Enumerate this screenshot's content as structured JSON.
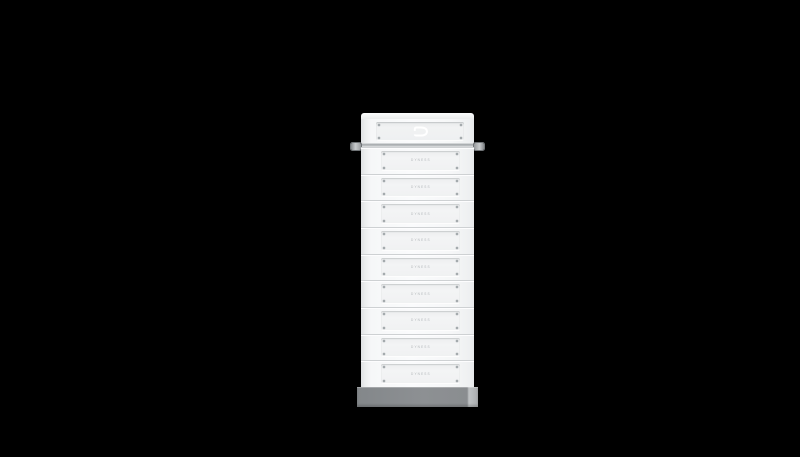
{
  "background": {
    "color": "#000000"
  },
  "product": {
    "logo_letter": "D",
    "battery_module_count": 9,
    "battery_modules": [
      {
        "label": "DYNESS"
      },
      {
        "label": "DYNESS"
      },
      {
        "label": "DYNESS"
      },
      {
        "label": "DYNESS"
      },
      {
        "label": "DYNESS"
      },
      {
        "label": "DYNESS"
      },
      {
        "label": "DYNESS"
      },
      {
        "label": "DYNESS"
      },
      {
        "label": "DYNESS"
      }
    ],
    "colors": {
      "background": "#000000",
      "body": "#f5f6f7",
      "panel": "#f0f1f3",
      "groove": "#ced1d3",
      "screw": "#9aa0a4",
      "label_text": "#b3b7ba",
      "rail": "#9fa4a7",
      "knob": "#a9adb0",
      "base": "#8b8e91",
      "logo": "#ffffff"
    }
  }
}
